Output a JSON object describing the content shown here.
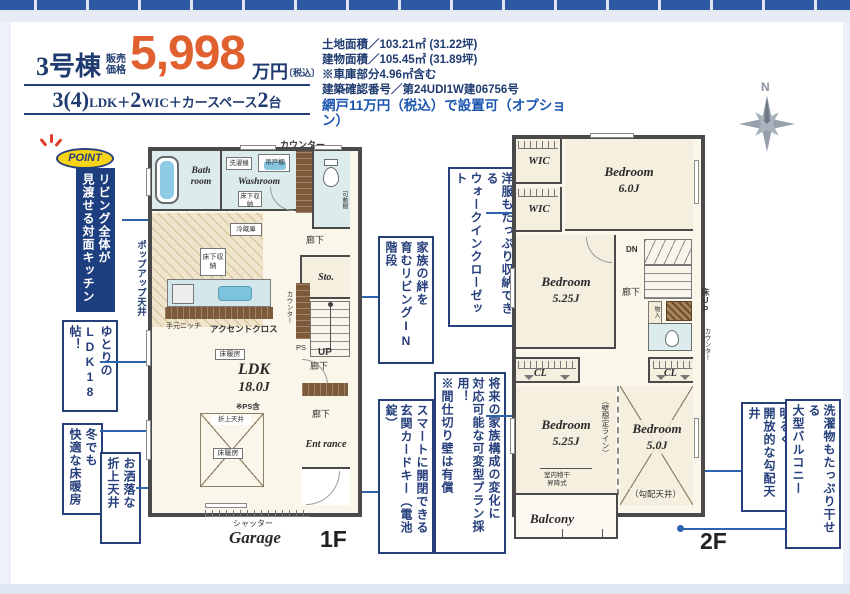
{
  "accents": {
    "navy": "#1f3b70",
    "orange": "#e0612f",
    "highlight_blue": "#1b55b0",
    "annotation_line": "#2e63ad",
    "wall": "#4a4a4a"
  },
  "header": {
    "building": "3号棟",
    "price_label1": "販売",
    "price_label2": "価格",
    "price": "5,998",
    "unit": "万円",
    "tax": "〔税込〕",
    "seg1": "3(4)",
    "seg2": "LDK＋",
    "seg3": "2",
    "seg4": "WIC＋カースペース",
    "seg5": "2",
    "seg6": "台"
  },
  "info": {
    "line1": "土地面積／103.21㎡ (31.22坪)",
    "line2": "建物面積／105.45㎡ (31.89坪)",
    "line3": "※車庫部分4.96㎡含む",
    "line4": "建築確認番号／第24UDI1W建06756号",
    "highlight": "網戸11万円（税込）で設置可（オプション）"
  },
  "compass": {
    "n": "N"
  },
  "annotations": {
    "badge": "POINT",
    "a1c1": "リビング全体が",
    "a1c2": "見渡せる対面キッチン",
    "a2c1": "ゆとりの",
    "a2c2": "LDK18帖！",
    "a3c1": "冬でも",
    "a3c2": "快適な床暖房",
    "a4c1": "お洒落な",
    "a4c2": "折上天井",
    "a5c1": "家族の絆を",
    "a5c2": "育むリビングIN階段",
    "a6c1": "洋服もたっぷり収納できる",
    "a6c2": "ウォークインクローゼット",
    "a7c1": "将来の家族構成の変化に",
    "a7c2": "対応可能な可変型プラン採用！",
    "a7c3": "※間仕切り壁は有償",
    "a8c1": "スマートに開閉できる",
    "a8c2": "玄関カードキー（電池錠）",
    "a9c1": "明るく",
    "a9c2": "開放的な勾配天井",
    "a10c1": "洗濯物もたっぷり干せる",
    "a10c2": "大型バルコニー"
  },
  "f1": {
    "counter_top": "カウンター",
    "bath": "Bath room",
    "washroom": "Washroom",
    "washer": "洗濯機",
    "cupboard": "吊戸棚",
    "underfloor1": "床下収納",
    "underfloor2": "床下収納",
    "movable_shelf": "可動棚",
    "fridge": "冷蔵庫",
    "hall1": "廊下",
    "hall2": "廊下",
    "hall3": "廊下",
    "sto": "Sto.",
    "up": "UP",
    "ps": "PS",
    "counter_side": "カウンター",
    "ldk": "LDK",
    "ldk_size": "18.0J",
    "ps_note": "※PS含",
    "yukadan1": "床暖房",
    "yukadan2": "床暖房",
    "oriage": "折上天井",
    "accent": "アクセントクロス",
    "niche": "手元ニッチ",
    "entrance": "Ent rance",
    "shutter": "シャッター",
    "garage": "Garage",
    "popup": "ポップアップ天井",
    "floor": "1F"
  },
  "f2": {
    "wic1": "WIC",
    "wic2": "WIC",
    "bed1": "Bedroom",
    "bed1_size": "6.0J",
    "bed2": "Bedroom",
    "bed2_size": "5.25J",
    "dn": "DN",
    "hall": "廊下",
    "storage": "物入",
    "yuka_up": "床UP",
    "counter_side": "カウンター",
    "cl1": "CL",
    "cl2": "CL",
    "bed3": "Bedroom",
    "bed3_size": "5.25J",
    "monohoshi1": "室内物干",
    "monohoshi2": "昇降式",
    "wall_line": "（壁想定ライン）",
    "wall_type": "準耐力壁",
    "bed4": "Bedroom",
    "bed4_size": "5.0J",
    "slope": "（勾配天井）",
    "balcony": "Balcony",
    "floor": "2F"
  }
}
